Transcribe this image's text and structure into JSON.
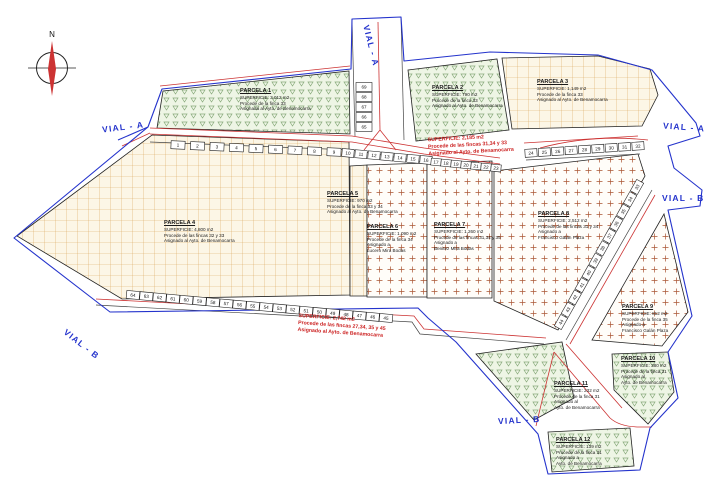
{
  "colors": {
    "paper": "#ffffff",
    "boundary_blue": "#2433cc",
    "road_red": "#cc3333",
    "vial_blue": "#2433cc",
    "ann_red": "#cc2222",
    "ink": "#1a1a1a",
    "green_fill": "#eef5e5",
    "green_mark": "#86a878",
    "tan_fill": "#fcf6e6",
    "tan_line": "#d9a45a",
    "plus_mark": "#aa5533"
  },
  "compass": {
    "north_label": "N"
  },
  "vial_labels": [
    "VIAL - A",
    "VIAL - A",
    "VIAL - A",
    "VIAL - B",
    "VIAL - B",
    "VIAL - B"
  ],
  "parcels": [
    {
      "name": "PARCELA 1",
      "lines": [
        "SUPERFICIE: 3,012 m2",
        "Procede de la finca 33",
        "Asignada al Ayto. de Benamocarra"
      ]
    },
    {
      "name": "PARCELA 2",
      "lines": [
        "SUPERFICIE: 790 m2",
        "Procede de la finca 33",
        "Asignado al Ayto. de Benamocarra"
      ]
    },
    {
      "name": "PARCELA 3",
      "lines": [
        "SUPERFICIE: 1,149 m2",
        "Procede de la finca 33",
        "Asignado al Ayto. de Benamocarra"
      ]
    },
    {
      "name": "PARCELA 4",
      "lines": [
        "SUPERFICIE: 4,800 m2",
        "Procede de las fincas 32 y 33",
        "Asignado al Ayto. de Benamocarra"
      ]
    },
    {
      "name": "PARCELA 5",
      "lines": [
        "SUPERFICIE: 970 m2",
        "Procede de la finca 33 y 34",
        "Asignado al Ayto. de Benamocarra"
      ]
    },
    {
      "name": "PARCELA 6",
      "lines": [
        "SUPERFICIE: 1,090 m2",
        "Procede de la finca 34",
        "Asignado a",
        "Lucero Mira Bodas"
      ]
    },
    {
      "name": "PARCELA 7",
      "lines": [
        "SUPERFICIE: 1,260 m2",
        "Procede de las fincas 31,34 y 35",
        "Asignado a",
        "Benitez Mira Bodas"
      ]
    },
    {
      "name": "PARCELA 8",
      "lines": [
        "SUPERFICIE: 2,512 m2",
        "Procede de las fincas 31 y 34",
        "Asignado a",
        "Francisco Galán Plaza"
      ]
    },
    {
      "name": "PARCELA 9",
      "lines": [
        "SUPERFICIE: 812 m2",
        "Procede de la finca 35",
        "Asignado a",
        "Francisco Galán Plaza"
      ]
    },
    {
      "name": "PARCELA 10",
      "lines": [
        "SUPERFICIE: 380 m2",
        "Procede de la finca 31",
        "Asignado al",
        "Ayto. de Benamocarra"
      ]
    },
    {
      "name": "PARCELA 11",
      "lines": [
        "SUPERFICIE: 232 m2",
        "Procede de la finca 31",
        "Asignado al",
        "Ayto. de Benamocarra"
      ]
    },
    {
      "name": "PARCELA 12",
      "lines": [
        "SUPERFICIE: 139 m2",
        "Procede de la finca 31",
        "Asignado a",
        "Ayto. de Benamocarra"
      ]
    }
  ],
  "annotations": [
    {
      "lines": [
        "SUPERFICIE: 2,185 m2",
        "Procede de las fincas 31,34 y 33",
        "Asignado al Ayto. de Benamocarra"
      ]
    },
    {
      "lines": [
        "SUPERFICIE: 2,742 m2",
        "Procede de las fincas 27,34, 35 y 45",
        "Asignado al Ayto. de Benamocarra"
      ]
    }
  ],
  "lot_strips": {
    "top_a": [
      "1",
      "2",
      "3",
      "4",
      "5",
      "6",
      "7",
      "8",
      "9"
    ],
    "top_b": [
      "10",
      "11",
      "12",
      "13",
      "14",
      "15",
      "16"
    ],
    "top_c": [
      "17",
      "18",
      "19",
      "20",
      "21",
      "22",
      "23"
    ],
    "top_d": [
      "24",
      "25",
      "26",
      "27",
      "28",
      "29",
      "30",
      "31",
      "32"
    ],
    "center_vertical": [
      "69",
      "68",
      "67",
      "66",
      "65"
    ],
    "right_diagonal": [
      "33",
      "34",
      "35",
      "36",
      "37",
      "38",
      "39",
      "40",
      "41",
      "42",
      "43",
      "44"
    ],
    "bottom": [
      "64",
      "63",
      "62",
      "61",
      "60",
      "59",
      "58",
      "57",
      "56",
      "55",
      "54",
      "53",
      "52",
      "51",
      "50",
      "49",
      "48",
      "47",
      "46",
      "45"
    ]
  }
}
